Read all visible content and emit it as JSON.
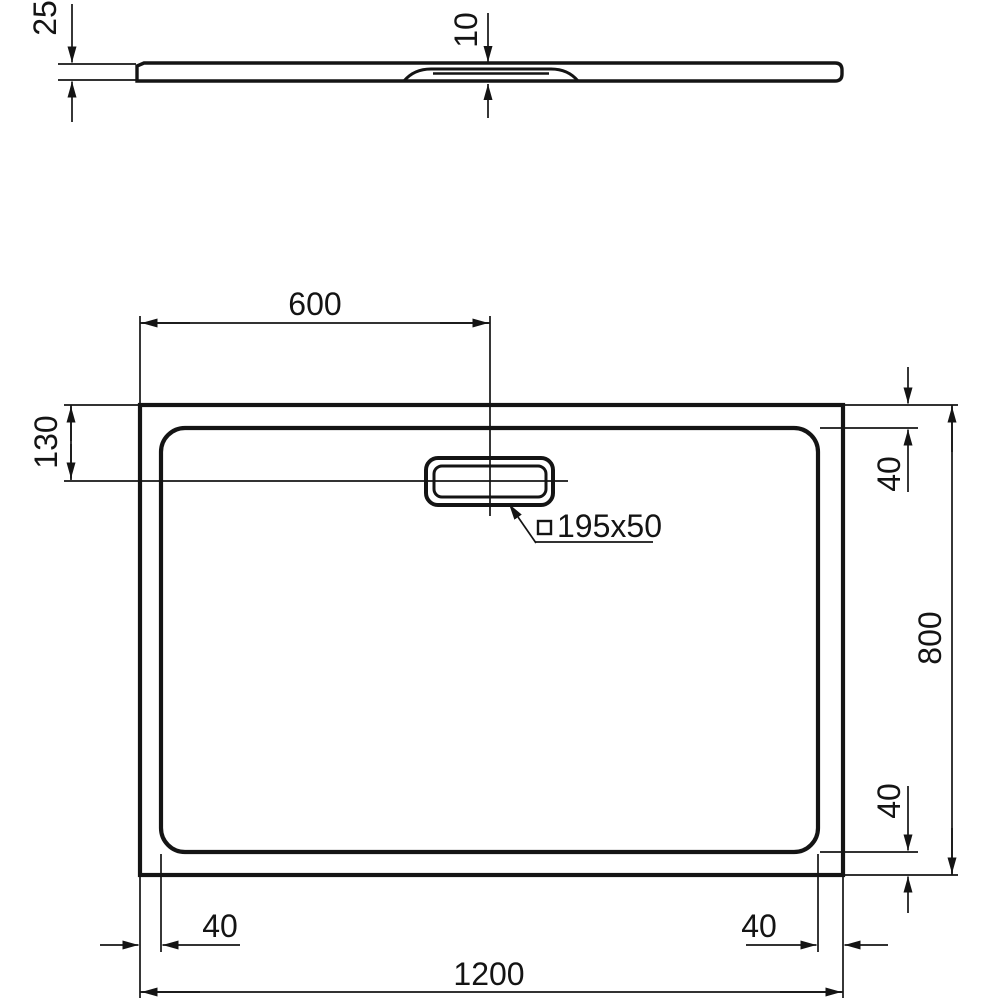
{
  "colors": {
    "ink": "#141414",
    "background": "#ffffff"
  },
  "side_view": {
    "overall_height_mm": "25",
    "recess_depth_mm": "10"
  },
  "plan_view": {
    "drain_center_from_left_mm": "600",
    "drain_center_from_top_mm": "130",
    "waste_cover_size_mm": "195x50",
    "top_rim_width_mm": "40",
    "overall_width_mm": "800",
    "bottom_rim_width_mm": "40",
    "left_rim_width_mm": "40",
    "right_rim_width_mm": "40",
    "overall_length_mm": "1200"
  }
}
